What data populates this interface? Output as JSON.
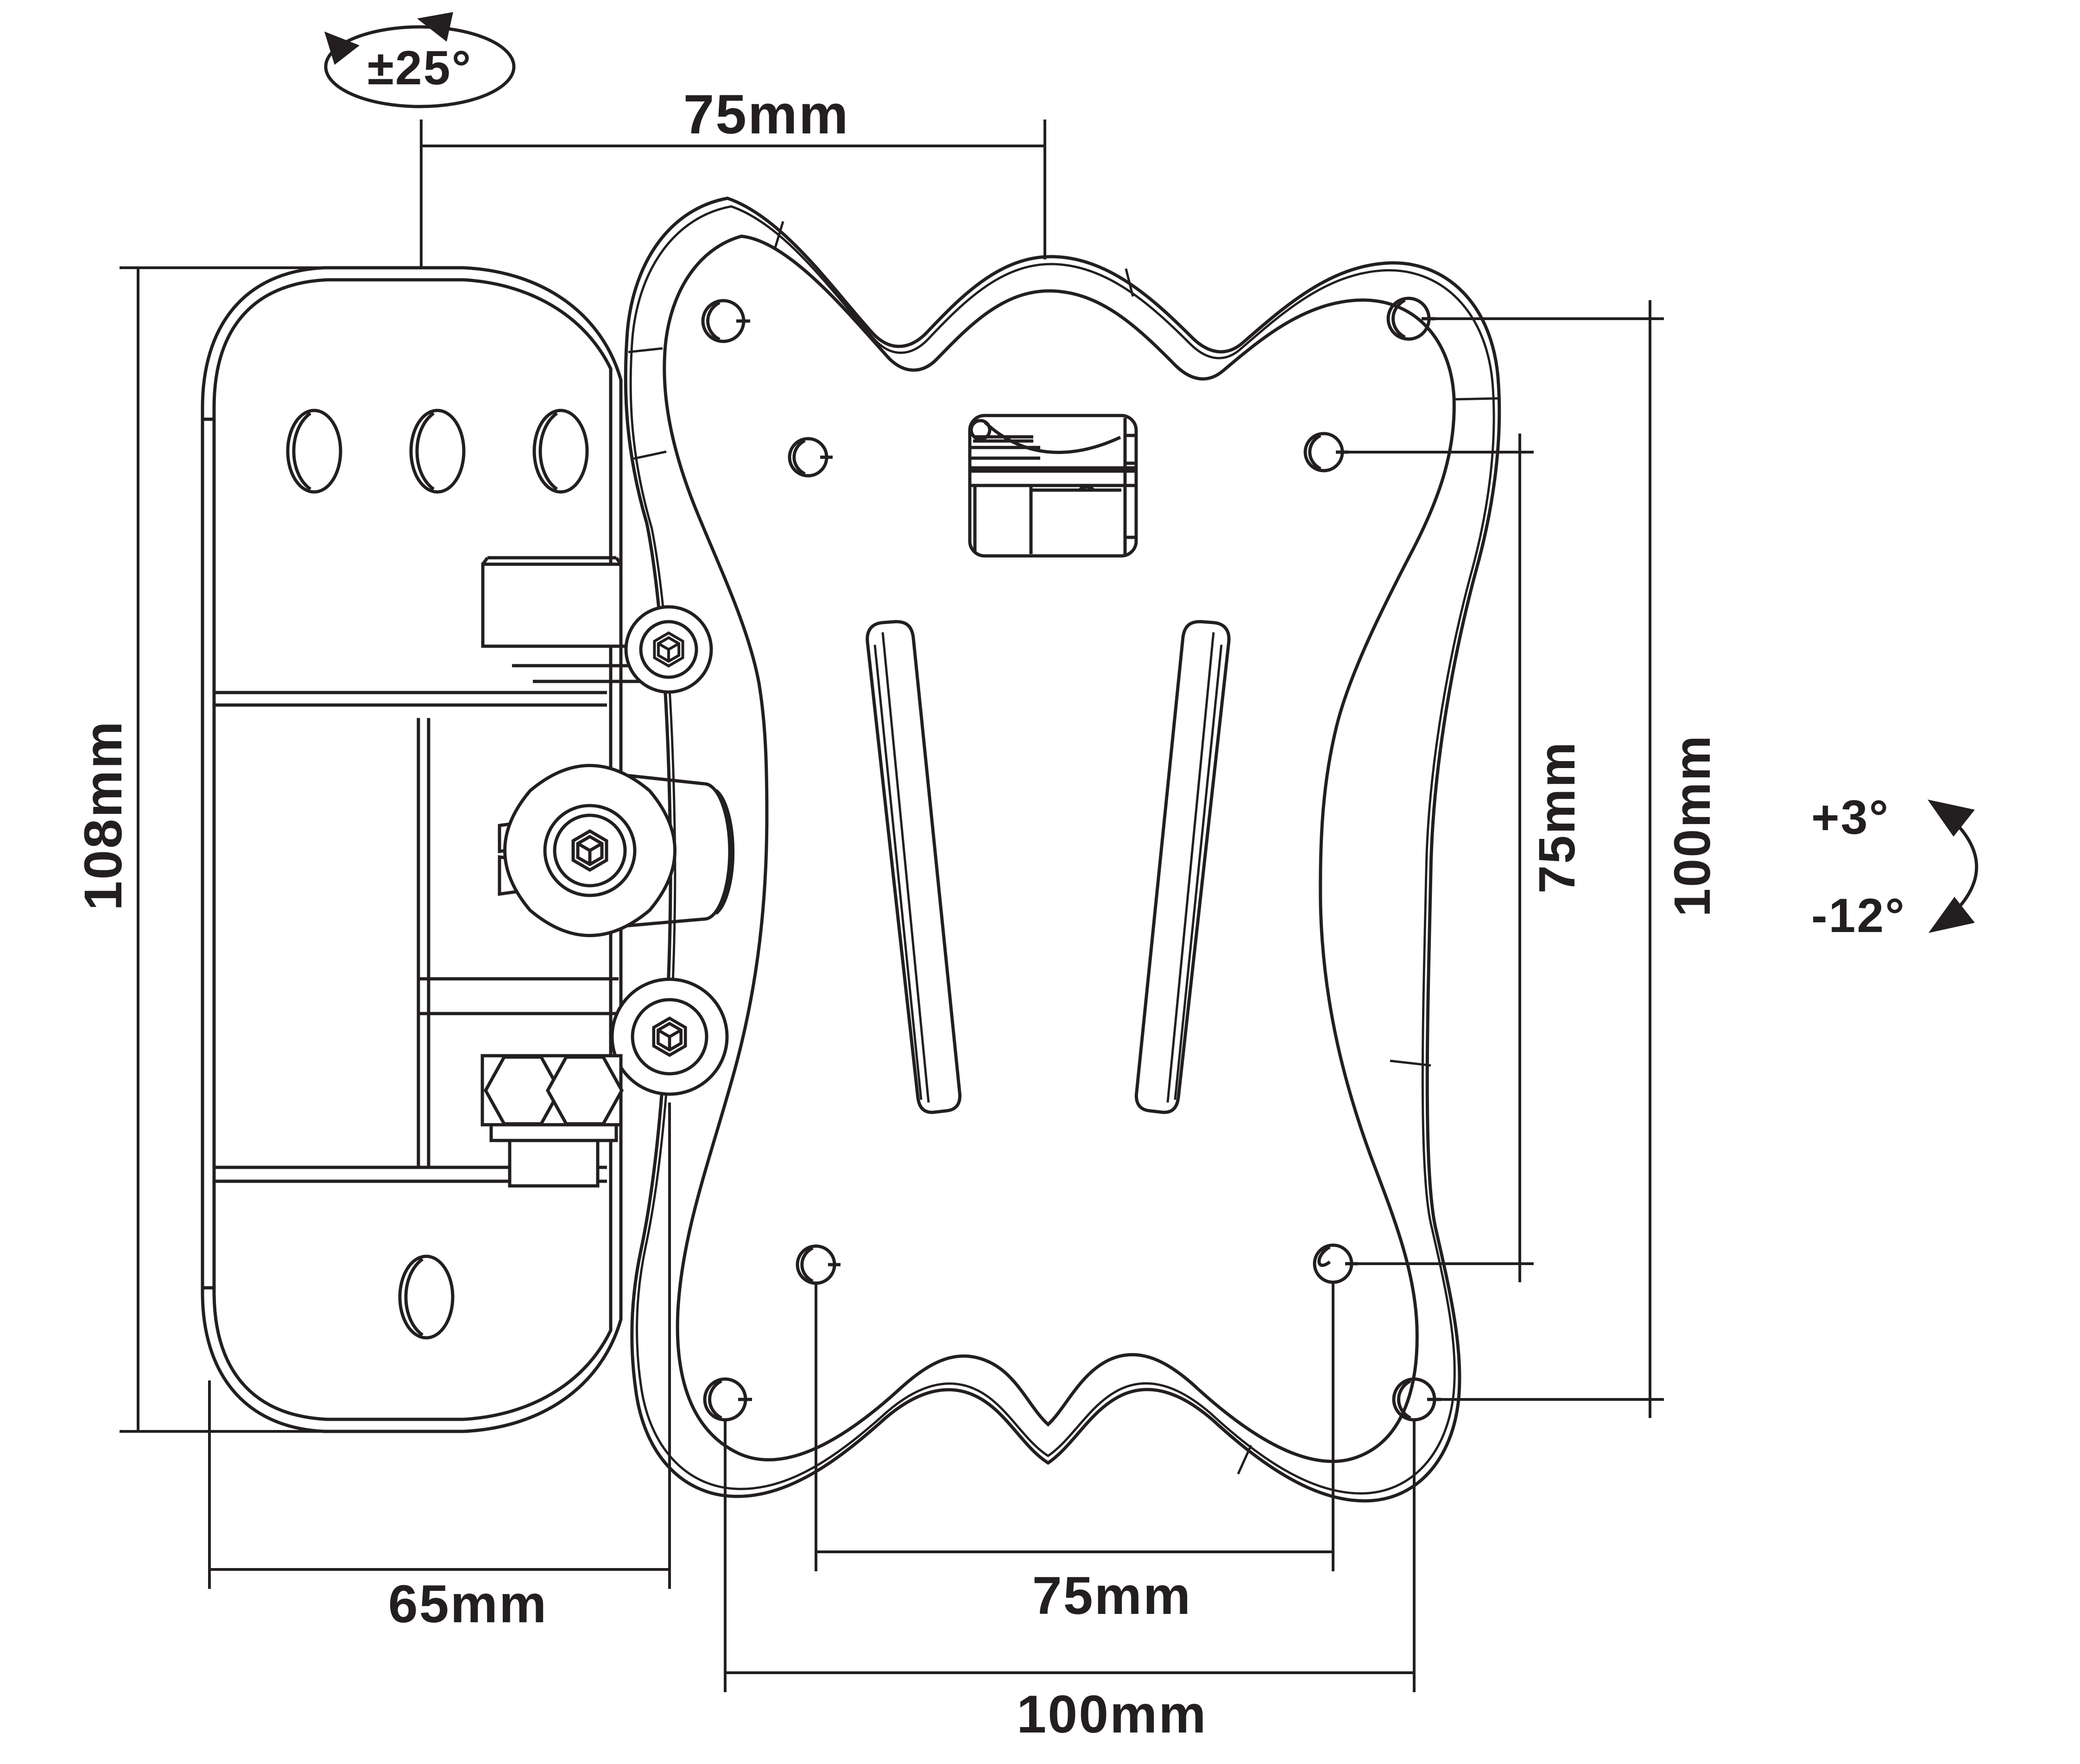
{
  "drawing": {
    "type": "technical-line-drawing",
    "subject": "tilt-and-swivel TV wall mount bracket with VESA adapter plate"
  },
  "labels": {
    "swivel_angle": "±25°",
    "top_width": "75mm",
    "left_height": "108mm",
    "depth": "65mm",
    "bottom_inner_width": "75mm",
    "bottom_outer_width": "100mm",
    "right_inner_height": "75mm",
    "right_outer_height": "100mm",
    "tilt_up": "+3°",
    "tilt_down": "-12°"
  },
  "colors": {
    "line": "#231f20",
    "background": "#ffffff"
  }
}
